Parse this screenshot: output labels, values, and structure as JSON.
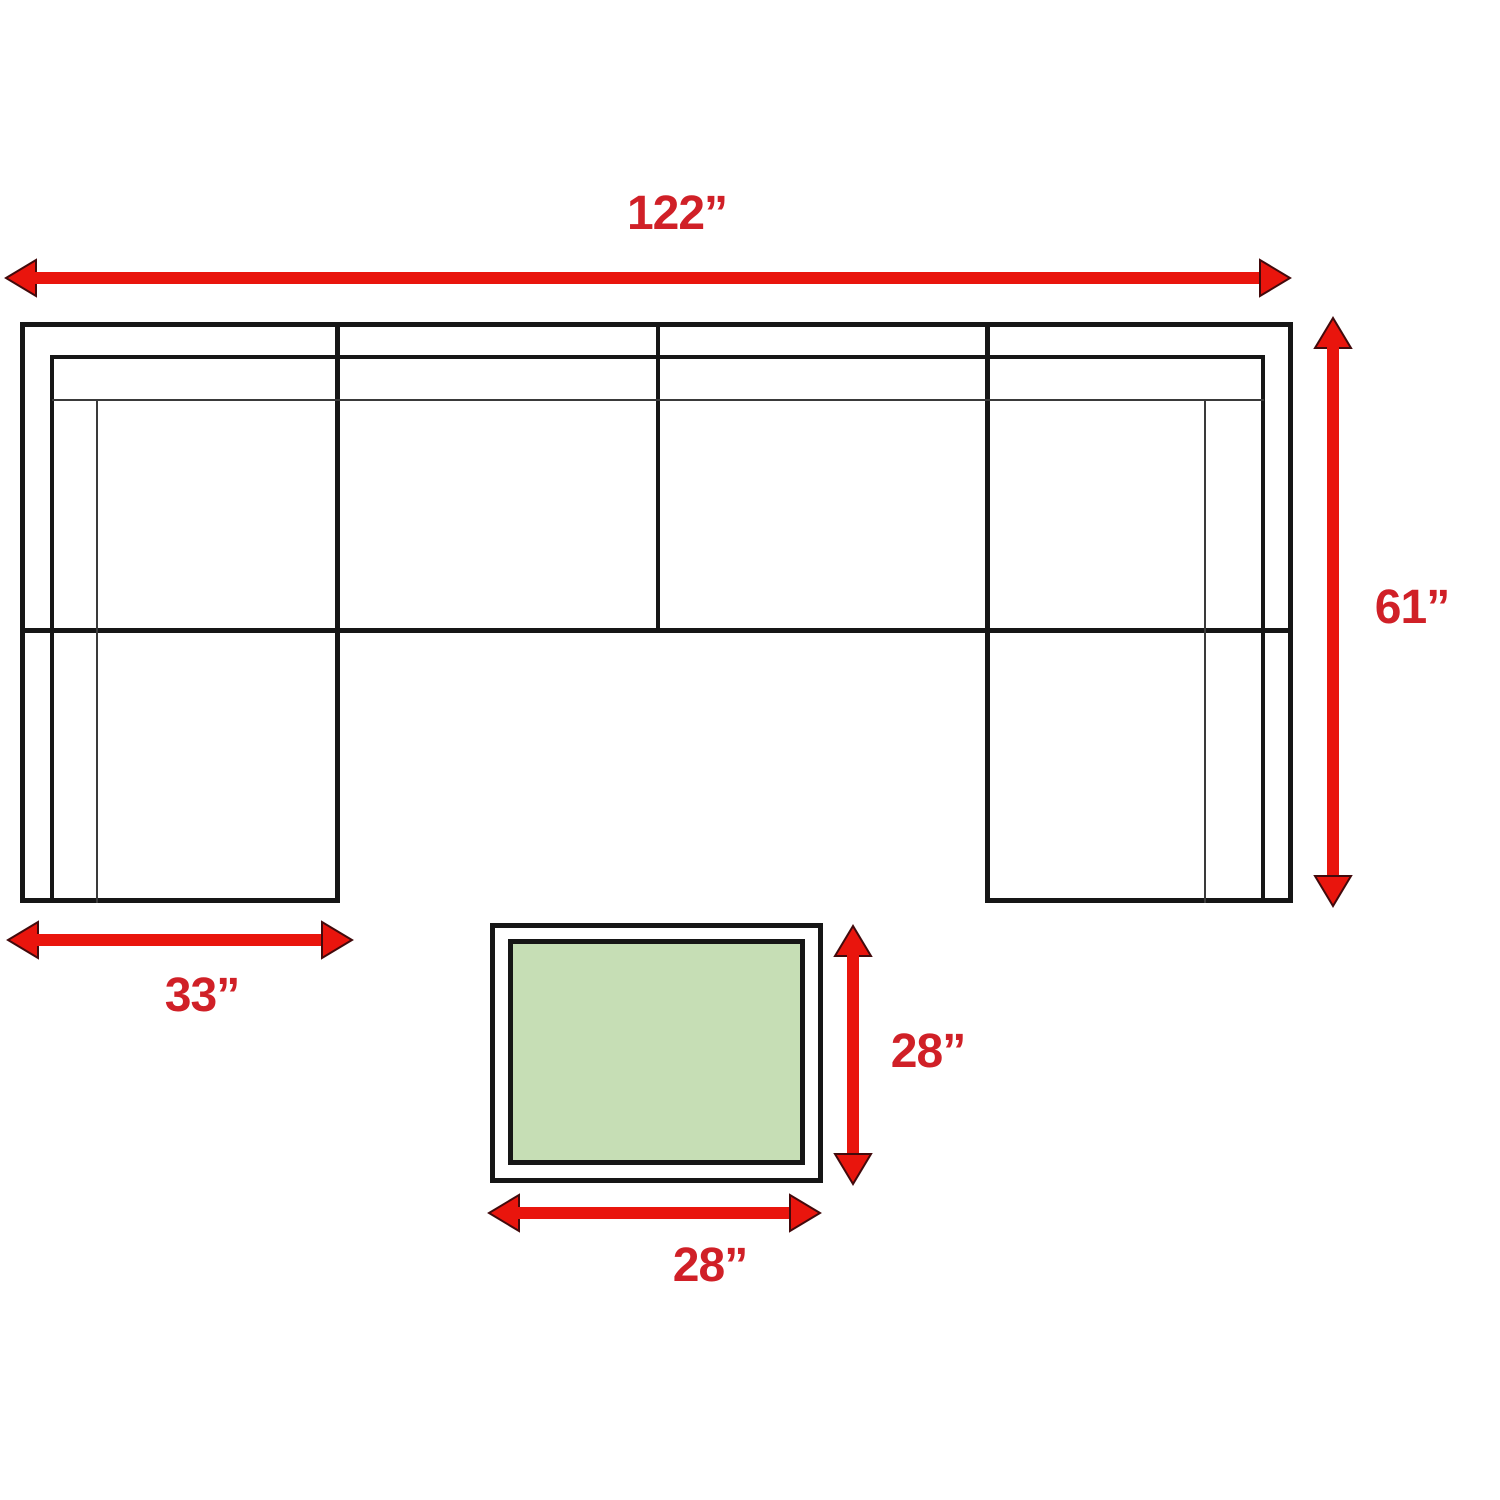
{
  "diagram": {
    "colors": {
      "background": "#ffffff",
      "arrow_red": "#e9150d",
      "arrowhead_outline": "#420a0c",
      "label_red": "#d02027",
      "line_black": "#161616",
      "line_thin": "#3a3a3a",
      "table_green": "#c6deb5"
    },
    "dimensions": {
      "sofa_width": {
        "label": "122”",
        "value": 122,
        "unit": "inches"
      },
      "sofa_depth": {
        "label": "61”",
        "value": 61,
        "unit": "inches"
      },
      "chaise_width": {
        "label": "33”",
        "value": 33,
        "unit": "inches"
      },
      "table_depth": {
        "label": "28”",
        "value": 28,
        "unit": "inches"
      },
      "table_width": {
        "label": "28”",
        "value": 28,
        "unit": "inches"
      }
    }
  }
}
